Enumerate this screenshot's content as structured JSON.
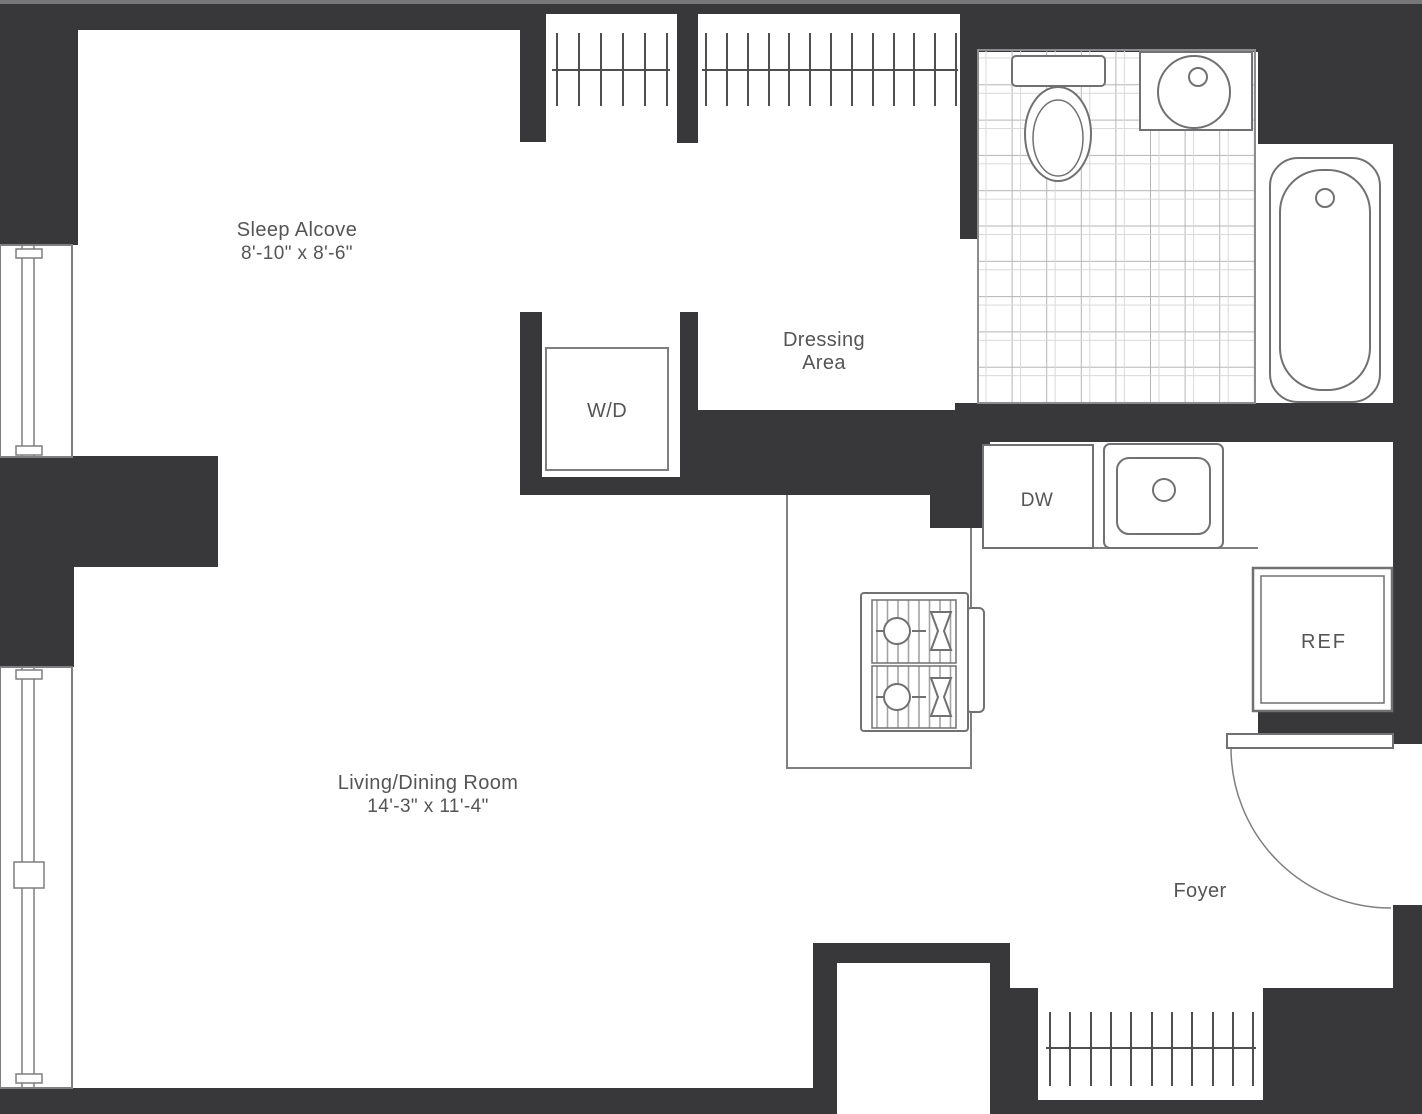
{
  "meta": {
    "title": "Studio apartment floor plan",
    "type": "architectural-floor-plan"
  },
  "colors": {
    "wall": "#38383a",
    "fixture_line": "#727274",
    "thin_line": "#7f7f81",
    "tile_line": "#b4b4b6",
    "text": "#555557",
    "background": "#ffffff"
  },
  "rooms": {
    "sleep_alcove": {
      "name": "Sleep Alcove",
      "dimensions": "8'-10\" x 8'-6\""
    },
    "dressing_area": {
      "name_line1": "Dressing",
      "name_line2": "Area"
    },
    "living_dining": {
      "name": "Living/Dining Room",
      "dimensions": "14'-3\" x 11'-4\""
    },
    "foyer": {
      "name": "Foyer"
    }
  },
  "appliances": {
    "washer_dryer": "W/D",
    "dishwasher": "DW",
    "refrigerator": "REF"
  },
  "fixtures": [
    "toilet",
    "vanity-sink",
    "bathtub",
    "kitchen-sink",
    "range-stove",
    "entry-door-swing",
    "closet-hanging-rods",
    "windows"
  ]
}
